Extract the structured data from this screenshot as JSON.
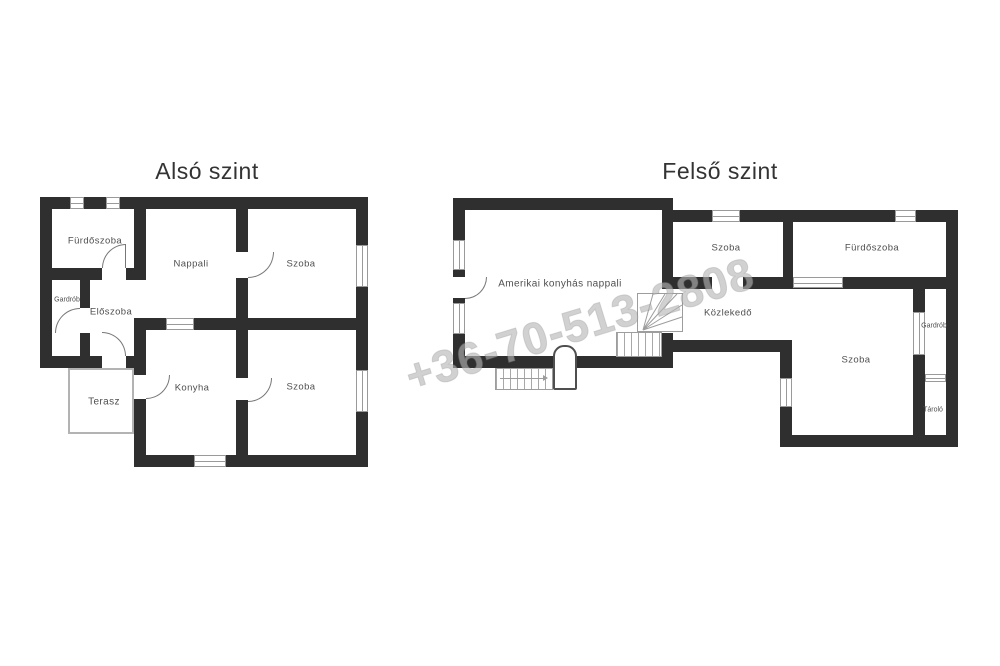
{
  "watermark": {
    "text": "+36-70-513-2808"
  },
  "floors": [
    {
      "title": "Alsó szint",
      "rooms": [
        {
          "label": "Fürdőszoba"
        },
        {
          "label": "Nappali"
        },
        {
          "label": "Szoba"
        },
        {
          "label": "Gardrób"
        },
        {
          "label": "Előszoba"
        },
        {
          "label": "Terasz"
        },
        {
          "label": "Konyha"
        },
        {
          "label": "Szoba"
        }
      ]
    },
    {
      "title": "Felső szint",
      "rooms": [
        {
          "label": "Amerikai konyhás nappali"
        },
        {
          "label": "Szoba"
        },
        {
          "label": "Fürdőszoba"
        },
        {
          "label": "Közlekedő"
        },
        {
          "label": "Szoba"
        },
        {
          "label": "Gardrób"
        },
        {
          "label": "Tároló"
        }
      ]
    }
  ],
  "colors": {
    "wall": "#2f2f2f",
    "room_label": "#4f4f4f",
    "thin": "#9a9a9a",
    "watermark": "#b5b5b5"
  }
}
